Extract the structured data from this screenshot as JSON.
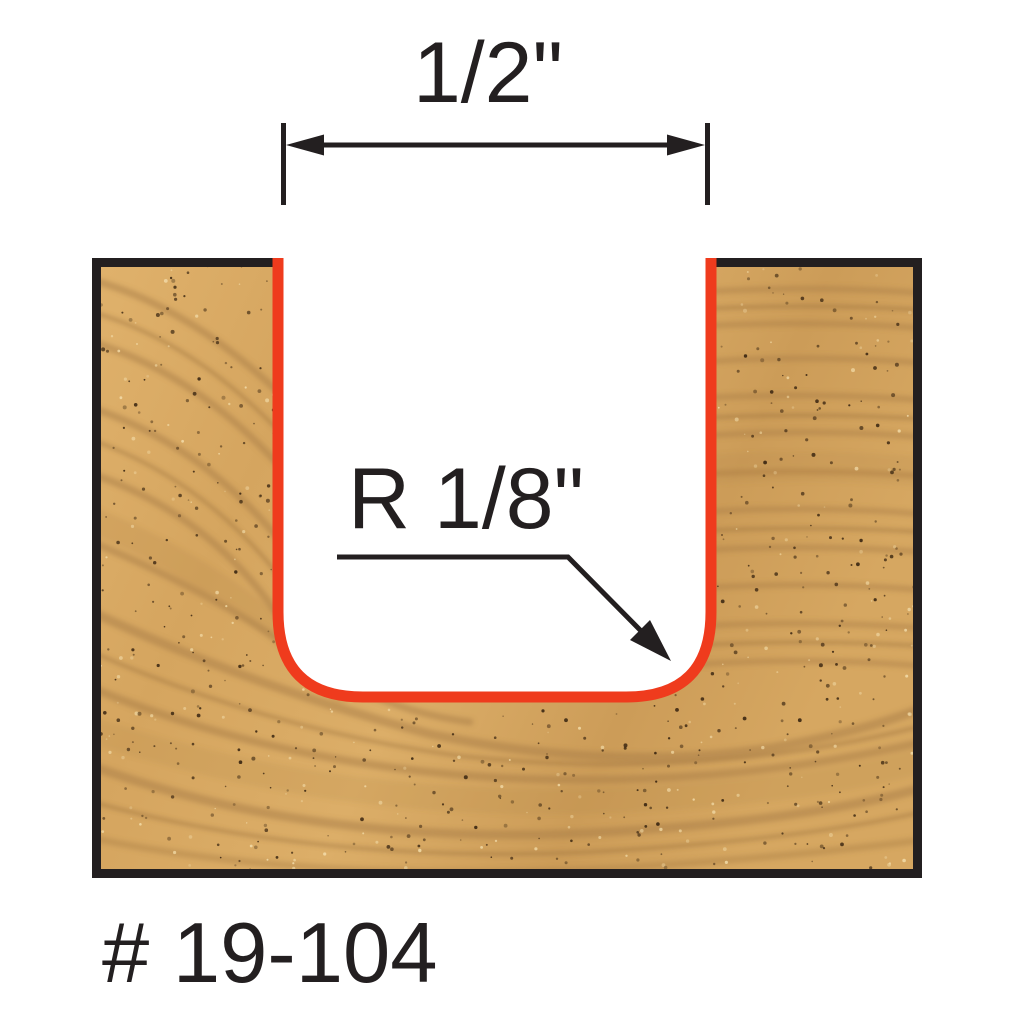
{
  "diagram": {
    "type": "router-bit-cutting-profile",
    "part_number": "# 19-104",
    "width_dimension": {
      "label": "1/2\""
    },
    "radius_dimension": {
      "label": "R 1/8\""
    },
    "colors": {
      "background": "#ffffff",
      "line_black": "#231f20",
      "profile_red": "#ef3b1d",
      "wood_base": "#d5a55f",
      "wood_base_light": "#e0b26c",
      "wood_base_dark": "#cc9c58",
      "wood_grain": "#a87c45",
      "wood_speckle_dark": "#2f1d0c",
      "wood_speckle_light": "#f3ddaa"
    }
  }
}
